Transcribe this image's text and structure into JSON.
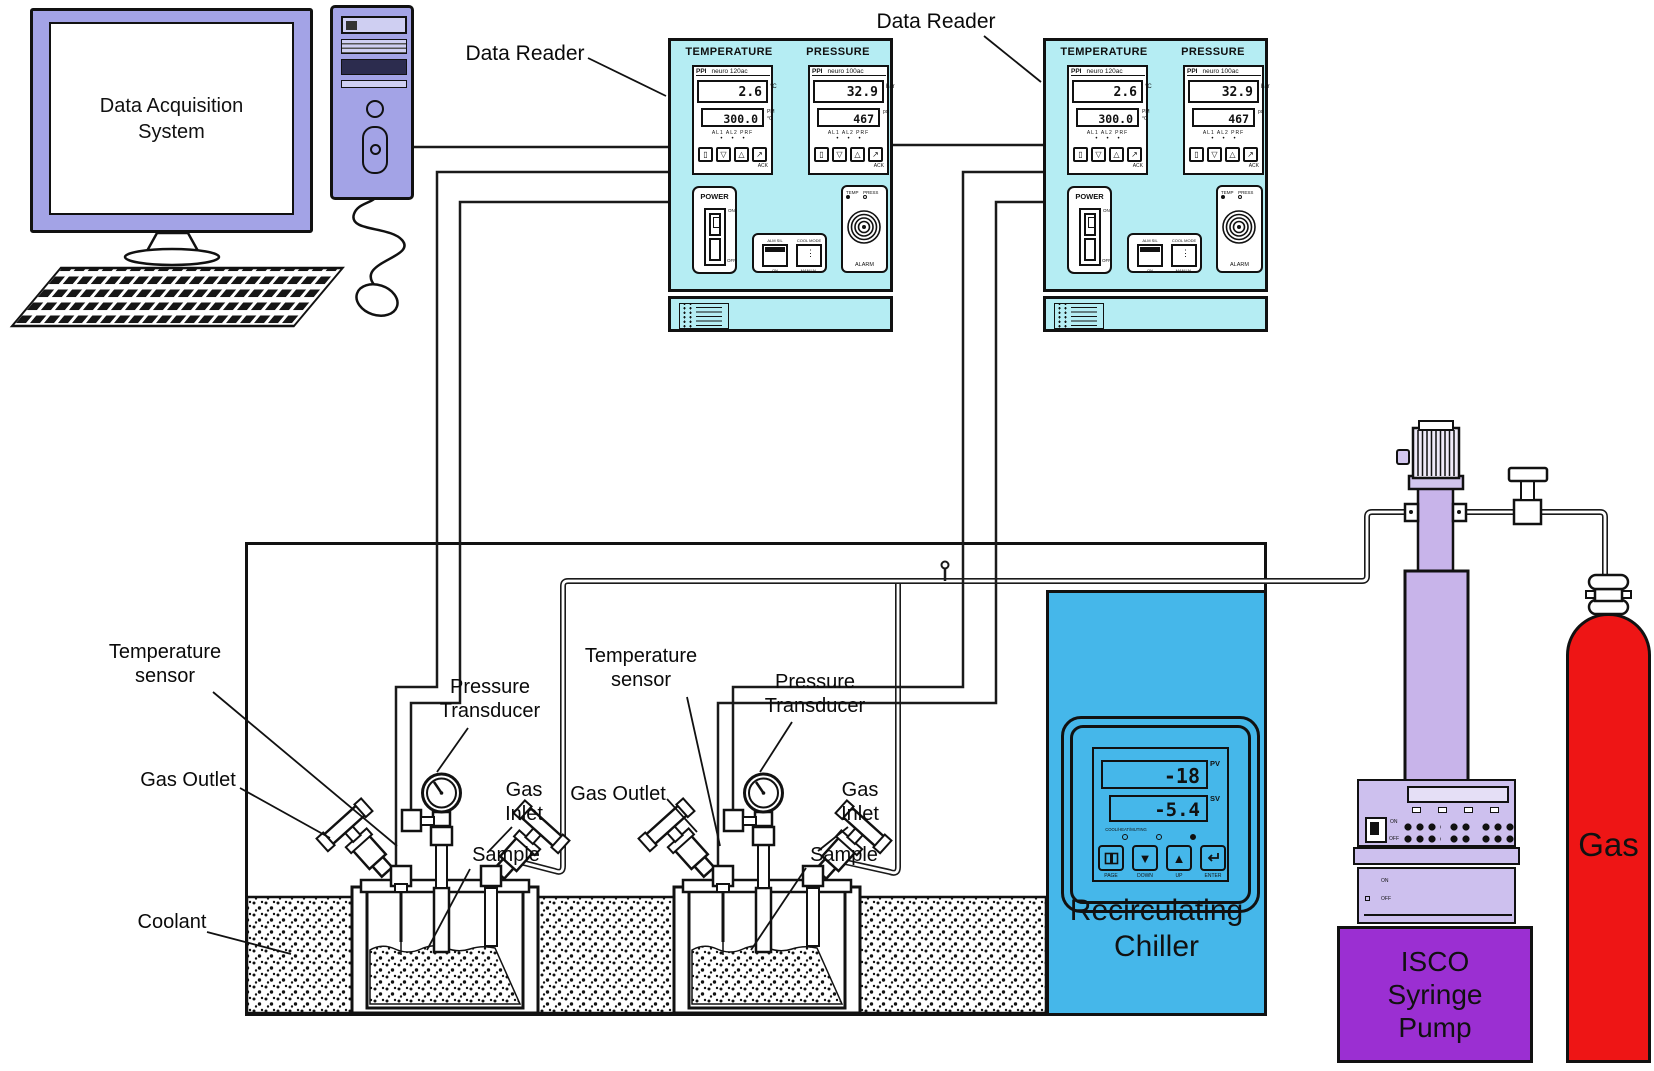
{
  "colors": {
    "panel_cyan": "#b5edf3",
    "chiller_blue": "#45b7ea",
    "computer_periwinkle": "#a3a3e6",
    "pump_lavender": "#cdc0ee",
    "pump_purple": "#9b2fd2",
    "gas_red": "#ee1515",
    "line": "#111111"
  },
  "monitor": {
    "label": "Data Acquisition\nSystem"
  },
  "labels": {
    "data_reader_1": "Data Reader",
    "data_reader_2": "Data Reader",
    "temperature_sensor_1": "Temperature\nsensor",
    "temperature_sensor_2": "Temperature\nsensor",
    "pressure_transducer_1": "Pressure\nTransducer",
    "pressure_transducer_2": "Pressure\nTransducer",
    "gas_outlet_1": "Gas Outlet",
    "gas_outlet_2": "Gas Outlet",
    "gas_inlet_1": "Gas\nInlet",
    "gas_inlet_2": "Gas\nInlet",
    "sample_1": "Sample",
    "sample_2": "Sample",
    "coolant": "Coolant"
  },
  "readers": [
    {
      "temp_title": "TEMPERATURE",
      "press_title": "PRESSURE",
      "brand": "PPI",
      "temp_model": "neuro 120ac",
      "press_model": "neuro 100ac",
      "temp_pv": "2.6",
      "temp_pv_unit": "°C",
      "temp_sv": "300.0",
      "temp_sv_units": "PM\n°C",
      "press_pv": "32.9",
      "press_pv_unit": "bar",
      "press_sv": "467",
      "press_sv_units": "psi",
      "led_row": "AL1 AL2 PRF",
      "led_dots": "•••",
      "btn_glyph_1": "▯",
      "btn_glyph_2": "▽",
      "btn_glyph_3": "△",
      "btn_glyph_4": "↗",
      "ack": "ACK",
      "power_label": "POWER",
      "power_on": "ON",
      "power_off": "OFF",
      "btn_a_top": "ALM SIL",
      "btn_a_bottom": "ON",
      "btn_b_top": "COOL MODE",
      "btn_b_bottom": "MANUAL",
      "alarm_temp": "TEMP",
      "alarm_press": "PRESS",
      "alarm_label": "ALARM"
    },
    {
      "temp_title": "TEMPERATURE",
      "press_title": "PRESSURE",
      "brand": "PPI",
      "temp_model": "neuro 120ac",
      "press_model": "neuro 100ac",
      "temp_pv": "2.6",
      "temp_pv_unit": "°C",
      "temp_sv": "300.0",
      "temp_sv_units": "PM\n°C",
      "press_pv": "32.9",
      "press_pv_unit": "bar",
      "press_sv": "467",
      "press_sv_units": "psi",
      "led_row": "AL1 AL2 PRF",
      "led_dots": "•••",
      "btn_glyph_1": "▯",
      "btn_glyph_2": "▽",
      "btn_glyph_3": "△",
      "btn_glyph_4": "↗",
      "ack": "ACK",
      "power_label": "POWER",
      "power_on": "ON",
      "power_off": "OFF",
      "btn_a_top": "ALM SIL",
      "btn_a_bottom": "ON",
      "btn_b_top": "COOL MODE",
      "btn_b_bottom": "MANUAL",
      "alarm_temp": "TEMP",
      "alarm_press": "PRESS",
      "alarm_label": "ALARM"
    }
  ],
  "chiller": {
    "pv": "-18",
    "pv_label": "PV",
    "sv": "-5.4",
    "sv_label": "SV",
    "led_caption": "COOL/HEAT/MUTING",
    "glyph_down": "▼",
    "glyph_up": "▲",
    "btn_page": "PAGE",
    "btn_down": "DOWN",
    "btn_up": "UP",
    "btn_enter": "ENTER",
    "name": "Recirculating\nChiller"
  },
  "pump": {
    "switch_on": "ON",
    "switch_off": "OFF",
    "box_on": "ON",
    "box_off": "OFF",
    "name": "ISCO\nSyringe\nPump"
  },
  "gas_cylinder": {
    "name": "Gas"
  }
}
